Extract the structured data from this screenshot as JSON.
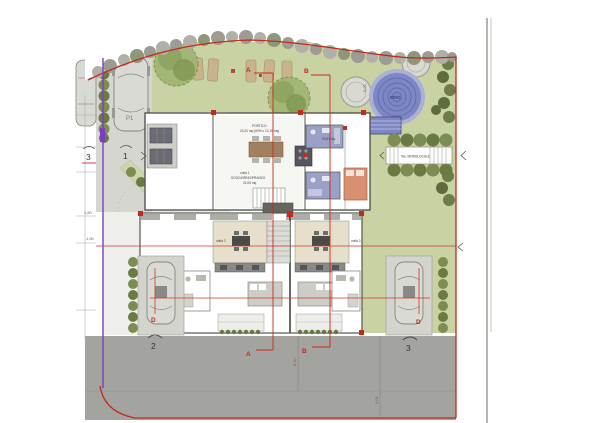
{
  "title": "totale 219,54 mq.",
  "labels": {
    "parking": "P1",
    "pool": "IDRO",
    "walkway": "Tav. MONOLOCALE",
    "portico": "PORTICO",
    "portico_area": "20,20 mq (60% v 12,19 mq)",
    "unit1": "unità 1",
    "unit1_room": "SOGGIORNO/PRANZO",
    "unit1_area": "24,05 mq",
    "right_area": "20,81 mq",
    "unit2": "unità 2",
    "unit3": "unità 3"
  },
  "sections": {
    "a_top": "A",
    "b_top": "B",
    "a_bottom": "A",
    "b_bottom": "B",
    "d_left": "D",
    "d_right": "D"
  },
  "views": {
    "left_3": "3",
    "left_1": "1",
    "bottom_2": "2",
    "bottom_3": "3"
  },
  "dims": {
    "d180": "1,80",
    "d150": "1,50",
    "d500": "5,00",
    "d800": "8,00",
    "d501": "5,01"
  },
  "colors": {
    "boundary_red": "#c22a1c",
    "boundary_purple": "#7a3fc0",
    "lawn": "#c8d2a2",
    "pool": "#7e86c4",
    "road": "#a3a3a0"
  }
}
